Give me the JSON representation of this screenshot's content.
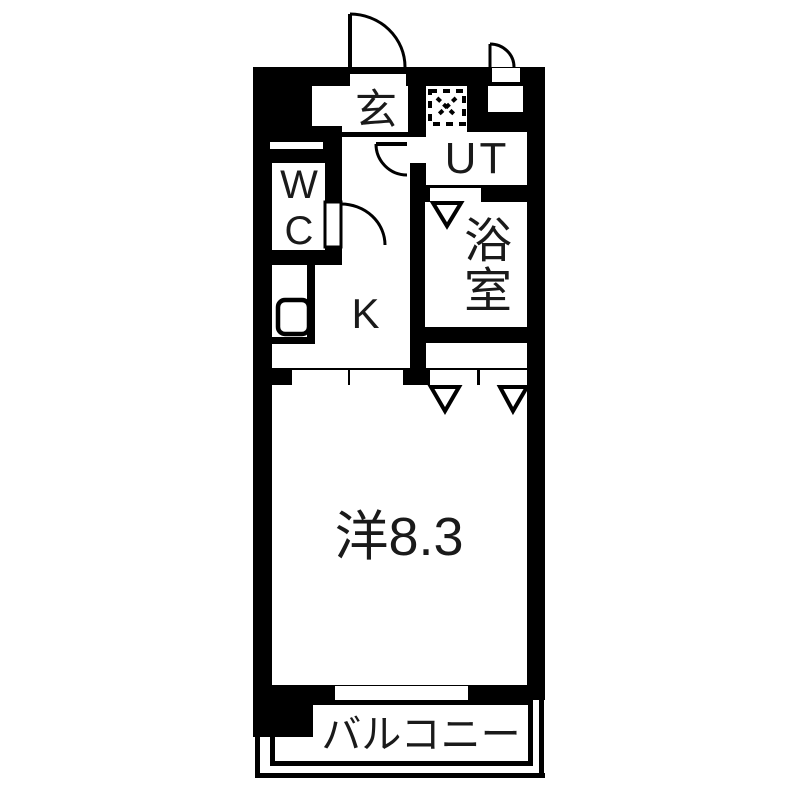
{
  "plan": {
    "type": "apartment-floor-plan",
    "rooms": {
      "genkan": {
        "label": "玄"
      },
      "utility": {
        "label": "UT"
      },
      "toilet": {
        "label": "WC"
      },
      "bathroom": {
        "label": "浴室"
      },
      "kitchen": {
        "label": "K"
      },
      "western_room": {
        "label": "洋8.3"
      },
      "balcony": {
        "label": "バルコニー"
      }
    },
    "icons": {
      "washing_machine_icon": "dashed square with cross (washer location)",
      "kitchen_sink_icon": "rounded square outline",
      "swing_door_icon": "quarter-circle door swing arc",
      "folding_door_icon": "downward triangle marker",
      "sliding_door_icon": "white panel pair in wall"
    },
    "colors": {
      "wall": "#000000",
      "background": "#ffffff",
      "text": "#1a1a1a"
    }
  }
}
